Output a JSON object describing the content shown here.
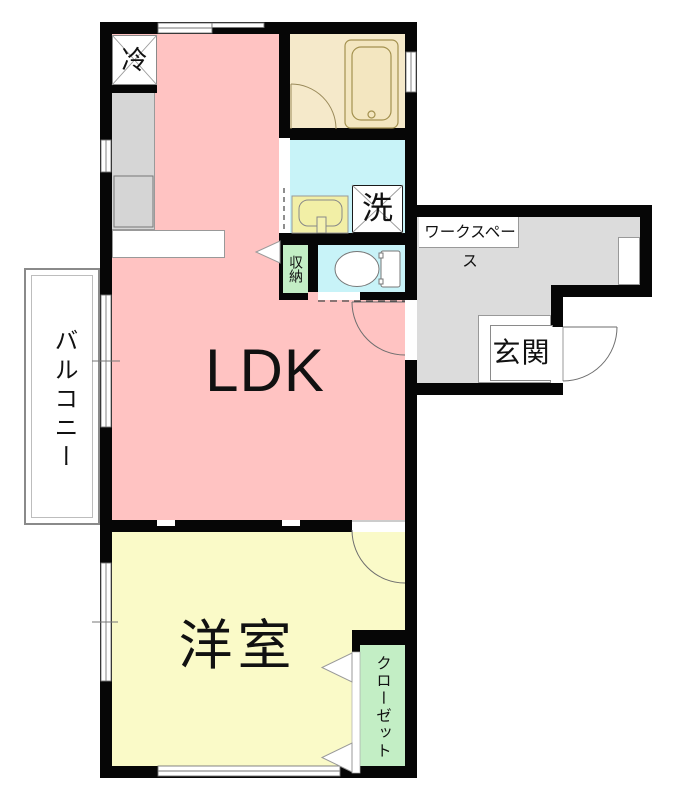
{
  "floorplan": {
    "labels": {
      "ldk": "LDK",
      "western_room": "洋室",
      "balcony": "バルコニー",
      "entrance": "玄関",
      "workspace": "ワークスペース",
      "storage": "収納",
      "closet": "クローゼット",
      "refrigerator": "冷",
      "washing_machine": "洗"
    },
    "colors": {
      "ldk": "#FFC3C2",
      "western": "#FAFAC8",
      "wet": "#C8F3F8",
      "bath": "#F5E9CA",
      "green": "#C3EEC5",
      "gray": "#DCDCDC",
      "sink": "#F2EFA6",
      "wall": "#060606"
    }
  }
}
